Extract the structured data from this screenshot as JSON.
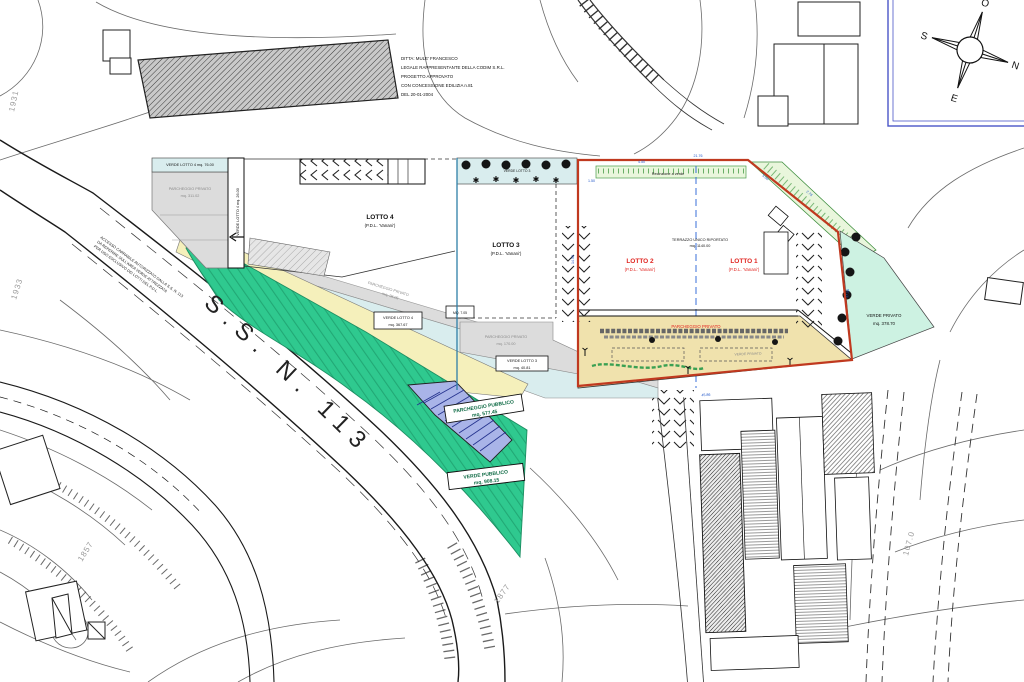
{
  "project_note": {
    "lines": [
      "DITTA: MULE' FRANCESCO",
      "LEGALE RAPPRESENTANTE DELLA CODIM S.R.L.",
      "PROGETTO APPROVATO",
      "CON CONCESSIONE EDILIZIA n.81",
      "DEL 20-01-2004"
    ]
  },
  "compass": {
    "north": "N",
    "south": "S",
    "east": "E",
    "west": "O"
  },
  "road": {
    "name": "S.S.  N.  113"
  },
  "lots": {
    "lotto1": {
      "name": "LOTTO 1",
      "sub": "(P.D.L. 'Vanani')"
    },
    "lotto2": {
      "name": "LOTTO 2",
      "sub": "(P.D.L. 'Vanani')"
    },
    "lotto3": {
      "name": "LOTTO 3",
      "sub": "(P.D.L. 'Vanani')"
    },
    "lotto4": {
      "name": "LOTTO 4",
      "sub": "(P.D.L. 'Vanani')"
    },
    "terrace_note": "TERRAZZO UNICO RIPORTATO",
    "terrace_area": "mq. 1140.00"
  },
  "areas": {
    "verde_lotto4_top": "VERDE LOTTO 4  mq. 76.00",
    "verde_lotto4_side": "VERDE LOTTO 4  mq. 26.00",
    "verde_lotto4_box1": "VERDE LOTTO 4",
    "verde_lotto4_box2": "mq. 367.67",
    "parcheggio_nw1": "PARCHEGGIO PRIVATO",
    "parcheggio_nw2": "mq. 311.02",
    "parcheggio_band1": "PARCHEGGIO PRIVATO",
    "parcheggio_band2": "mq. 26.06",
    "verde_lotto3_strip": "VERDE LOTTO 3",
    "mq_box": "MQ. 7.05",
    "parcheggio_l3a": "PARCHEGGIO PRIVATO",
    "parcheggio_l3b": "mq. 170.00",
    "verde_lotto3_box1": "VERDE LOTTO 3",
    "verde_lotto3_box2": "mq. 40.81",
    "recinzione": "Recinzione a verde",
    "parcheggio_lotti": "PARCHEGGIO PRIVATO",
    "verde_hedge": "VERDE PRIVATO",
    "verde_privato1": "VERDE PRIVATO",
    "verde_privato2": "mq. 378.70",
    "parcheggio_pubblico1": "PARCHEGGIO PUBBLICO",
    "parcheggio_pubblico2": "mq. 577.45",
    "verde_pubblico1": "VERDE PUBBLICO",
    "verde_pubblico2": "mq. 908.15"
  },
  "road_note": {
    "lines": [
      "ACCESSO CARRABILE AUTORIZZATO DALLA S.S. N. 113",
      "DA REPERIRE SULL'AREA VERDE ATTREZZATA",
      "PER USO ESCLUSIVO DEI LOTTI DEL P.D.L."
    ]
  },
  "parcels": {
    "p1931": "1931",
    "p1933": "1933",
    "p1857": "1857",
    "p1877": "1877",
    "p107": "107.0"
  },
  "dims": {
    "d1": "21.76",
    "d2": "5.00",
    "d3": "1.50",
    "d4": "4.50",
    "d5": "45.86",
    "d6": "14.50",
    "d7": "17.50",
    "d8": "2.76"
  },
  "colors": {
    "boundary_red": "#C0391F",
    "lot_text_red": "#E02520",
    "public_green": "#2FC98F",
    "mint_green": "#CDF2E2",
    "parking_blue": "#A9B4E8",
    "band_cyan": "#D9EDEE",
    "parking_tan": "#F0E2AD",
    "strip_yellow": "#F5F0BB",
    "hatch_green_strip": "#E9F6DC",
    "compass_frame_blue": "#4A55C8"
  }
}
